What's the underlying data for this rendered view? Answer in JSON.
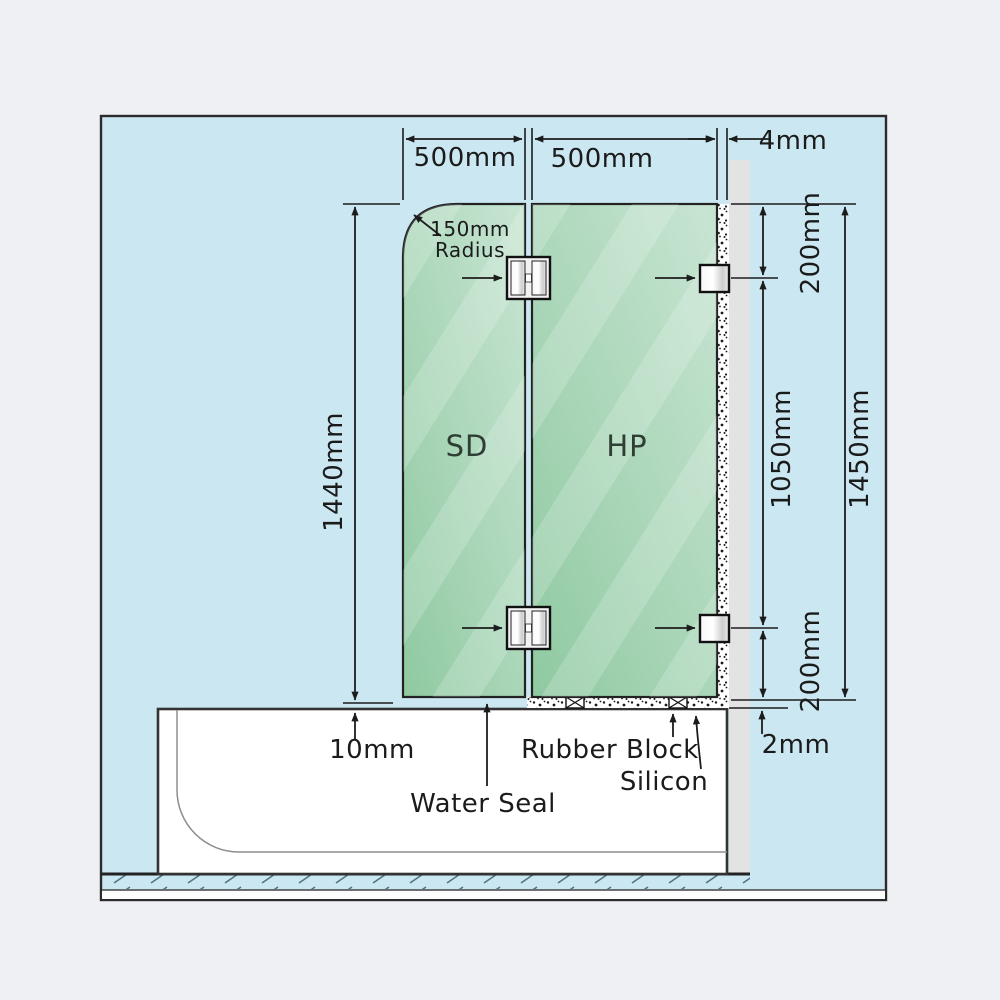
{
  "colors": {
    "page_bg": "#eef0f3",
    "diagram_bg": "#cbe8f2",
    "glass_dark": "#8fc9a1",
    "glass_light": "#c6e4d1",
    "wall_gray": "#e3e3e4",
    "line": "#1c1c1c",
    "hatch": "#4f7585"
  },
  "panels": {
    "sd_label": "SD",
    "hp_label": "HP"
  },
  "dimensions": {
    "sd_width": "500mm",
    "hp_width": "500mm",
    "wall_gap": "4mm",
    "corner_radius_line1": "150mm",
    "corner_radius_line2": "Radius",
    "sd_height": "1440mm",
    "top_bracket_offset": "200mm",
    "bracket_span": "1050mm",
    "total_height": "1450mm",
    "bottom_bracket_offset": "200mm",
    "bottom_gap": "2mm",
    "tub_gap": "10mm"
  },
  "callouts": {
    "water_seal": "Water Seal",
    "rubber_block": "Rubber Block",
    "silicon": "Silicon"
  }
}
